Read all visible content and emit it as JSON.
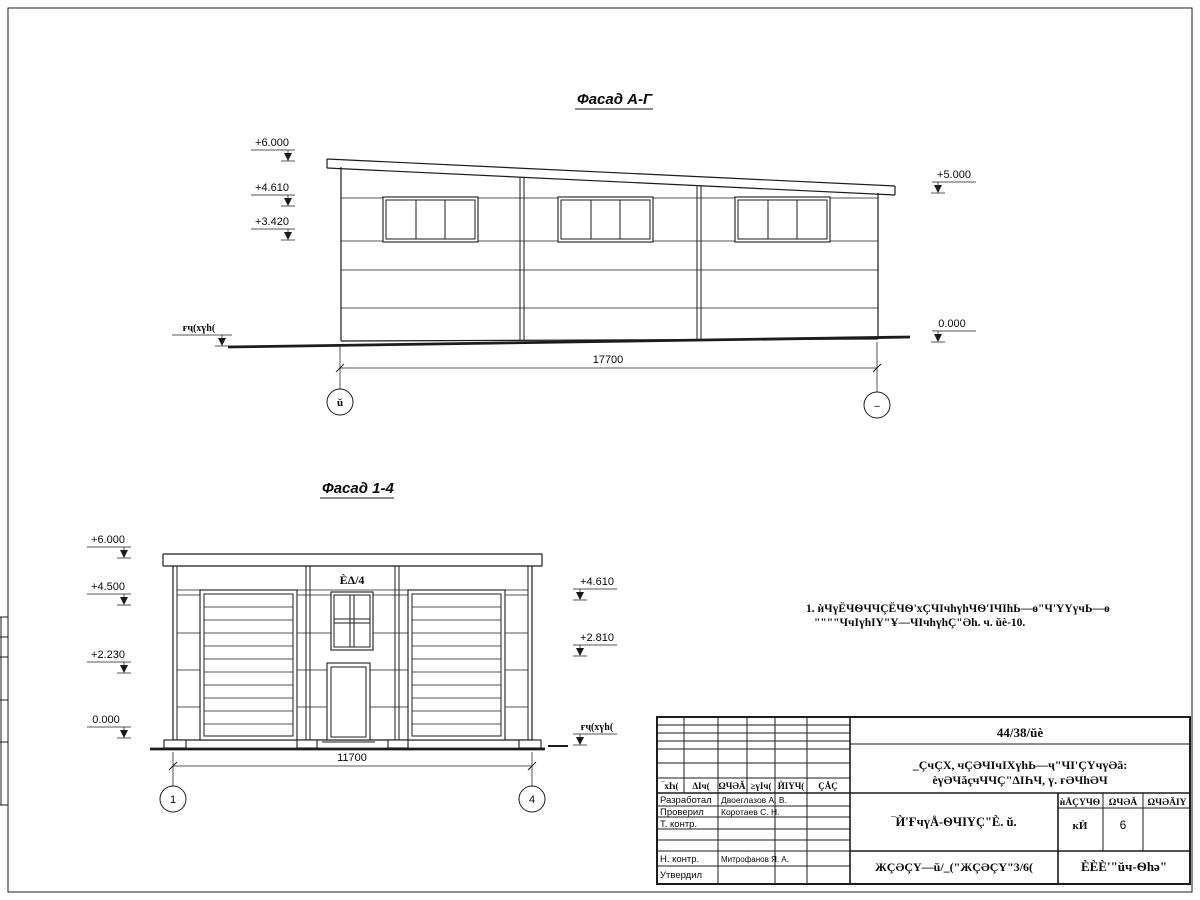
{
  "sheet": {
    "facade_ag": {
      "title": "Фасад А-Г",
      "elevations_left": [
        "+6.000",
        "+4.610",
        "+3.420"
      ],
      "elevations_right": [
        "+5.000",
        "0.000"
      ],
      "ground_label": "ғҷ(хүһ(",
      "dimension": "17700",
      "axis_left": "ŭ",
      "axis_right": "–"
    },
    "facade_14": {
      "title": "Фасад 1-4",
      "elevations_left": [
        "+6.000",
        "+4.500",
        "+2.230",
        "0.000"
      ],
      "elevations_right": [
        "+4.610",
        "+2.810"
      ],
      "ground_label": "ғҷ(хүһ(",
      "window_label": "ÈΔ/4",
      "dimension": "11700",
      "axis_left": "1",
      "axis_right": "4"
    },
    "note": {
      "line1": "1. ѝЧүЁЧѲЧЧÇЁЧѲ'хÇЧІчhүhЧѲ'ІЧІhЬ—ѳ\"Ч'ҮҮүчЬ—ѳ",
      "line2": "\"\"\"\"ЧчІүhІҮ\"Ұ—ЧІчhүhÇ\"Әh. ч. ŭè-10."
    },
    "titleblock": {
      "doc_number": "44/38/ŭè",
      "project_line1": "_ÇчÇХ, чÇӘЧІчІХүhЬ—ҷ\"ЧІ'ÇҮчүӘă:",
      "project_line2": "èүӘЧăçчЧЧÇ\"ΔІҺЧ, ү. ғӘЧhӘЧ",
      "header_cols": [
        "‾хҺ(",
        "ΔІч(",
        "ΩЧӘĂ",
        "≥үІч(",
        "ЍІҮЧ(",
        "ÇÅÇ"
      ],
      "rows": [
        {
          "label": "Разработал",
          "name": "Двоеглазов А. В."
        },
        {
          "label": "Проверил",
          "name": "Коротаев С. Н."
        },
        {
          "label": "Т. контр.",
          "name": ""
        },
        {
          "label": "",
          "name": ""
        },
        {
          "label": "Н. контр.",
          "name": "Митрофанов Я. А."
        },
        {
          "label": "Утвердил",
          "name": ""
        }
      ],
      "stage_title": "‾Ѝ'ҒчүÅ-ѲЧІҮÇ\"È. ŭ.",
      "sheet_title": "ЖÇӘÇҮ—ŭ/_(\"ЖÇӘÇҮ\"3/6(",
      "info_cols": [
        "ѝÅÇҮЧѲ",
        "ΩЧӘĂ",
        "ΩЧӘĂІҮ"
      ],
      "info_vals": [
        "кЍ",
        "6",
        ""
      ],
      "company": "ÈÈÈ'\"ŭч-Ѳhә\""
    }
  }
}
